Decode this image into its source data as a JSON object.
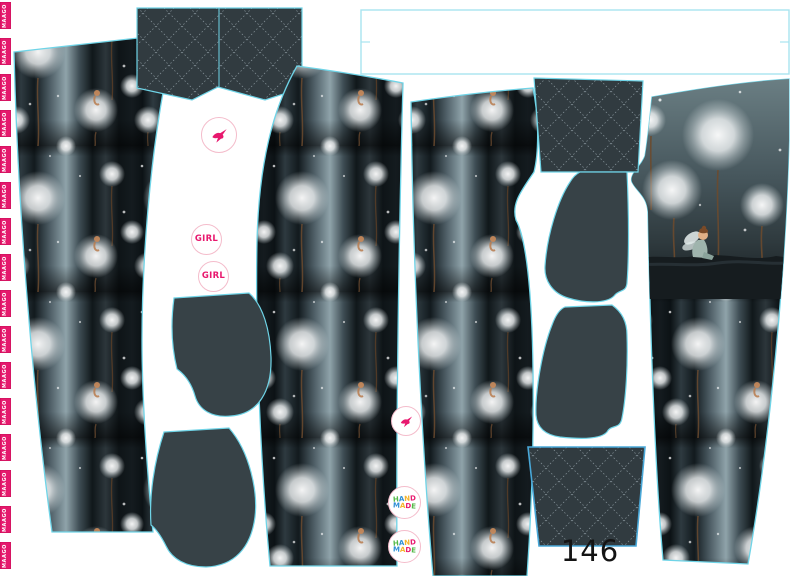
{
  "canvas": {
    "width": 792,
    "height": 576,
    "background": "#ffffff"
  },
  "product": {
    "kind": "printed sewing fabric panel",
    "garment": "kids leggings pattern pieces",
    "size_label": "146",
    "print_theme": "white dandelions and little fairies on dark grey forest background"
  },
  "selvedge": {
    "tag_label": "MAAGO",
    "tag_count": 16,
    "tag_color": "#e5196d",
    "text_color": "#ffffff"
  },
  "stickers": {
    "girl_label": "GIRL",
    "handmade_words": [
      "HAND",
      "MADE"
    ],
    "handmade_letter_colors": [
      "#53b948",
      "#2e8fd5",
      "#f5b32a",
      "#e8186e"
    ],
    "ring_color": "#f4bccb",
    "bird_color": "#e8186e",
    "girl_color": "#e8186e"
  },
  "colors": {
    "piece_outline": "#6fd4e7",
    "quilt_base": "#313b40",
    "quilt_stitch": "#97a4aa",
    "solid_piece": "#374247",
    "print_dark": "#10171b",
    "print_light": "#8fa3aa",
    "stem_brown": "#6b4a2e",
    "background": "#ffffff"
  },
  "pieces": [
    {
      "name": "legging-piece-1",
      "fill": "dandelion-print"
    },
    {
      "name": "waistband-piece-quilted-top",
      "fill": "quilt"
    },
    {
      "name": "waistband-blank-outline",
      "fill": "blank-white"
    },
    {
      "name": "legging-piece-2",
      "fill": "dandelion-print"
    },
    {
      "name": "legging-piece-3",
      "fill": "dandelion-print"
    },
    {
      "name": "legging-piece-4-with-fairy-panel",
      "fill": "dandelion-print + fairy panel"
    },
    {
      "name": "pocket-piece-1",
      "fill": "solid"
    },
    {
      "name": "pocket-piece-2",
      "fill": "solid"
    },
    {
      "name": "pocket-piece-3",
      "fill": "solid"
    },
    {
      "name": "pocket-piece-4",
      "fill": "solid"
    },
    {
      "name": "waistband-piece-quilted-mid",
      "fill": "quilt"
    },
    {
      "name": "cuff-piece-quilted",
      "fill": "quilt"
    }
  ]
}
